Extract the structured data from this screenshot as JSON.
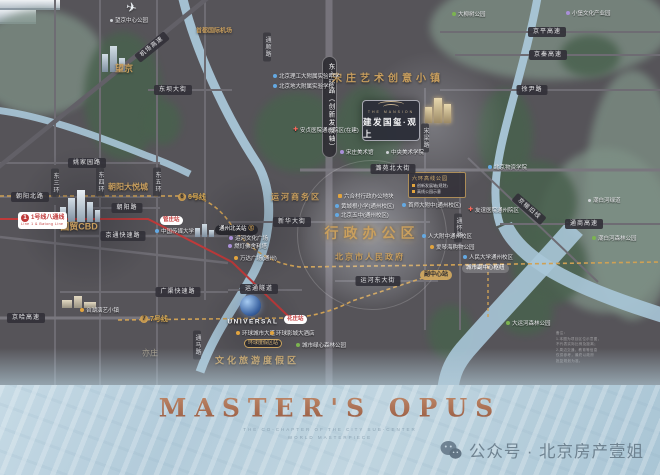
{
  "footer": {
    "title": "MASTER'S OPUS",
    "subtitle1": "THE CO-CHAPTER OF THE CITY SUB-CENTER",
    "subtitle2": "WORLD MASTERPIECE",
    "watermark": "公众号 · 北京房产壹姐"
  },
  "project_card": {
    "name_en": "THE MANSION",
    "name_cn": "建发国玺·观上"
  },
  "plan_card": {
    "title": "六环高线公园",
    "row1": "创新发展轴(规划)",
    "row2": "高线公园示意"
  },
  "ring_road_band": {
    "t": "东六环路（创新发展轴）"
  },
  "universal": {
    "t": "UNIVERSAL"
  },
  "disclaimer": {
    "lines": [
      "备注：",
      "1.本图为项目区位示意图，",
      "不代表实际比例及距离；",
      "2.周边交通、教育等信息",
      "仅供参考，最终以政府",
      "批复规划为准。"
    ]
  },
  "colors": {
    "gold": "#c99f5e",
    "metro_red": "#c03a3a",
    "river": "#a9c6d8",
    "copper": "#a8654a"
  },
  "zones": [
    {
      "t": "望京",
      "x": 124,
      "y": 68,
      "s": 9
    },
    {
      "t": "首都国际机场",
      "x": 214,
      "y": 30,
      "s": 6
    },
    {
      "t": "朝阳大悦城",
      "x": 128,
      "y": 187,
      "s": 8
    },
    {
      "t": "国贸CBD",
      "x": 79,
      "y": 226,
      "s": 9
    },
    {
      "t": "宋庄艺术创意小镇",
      "x": 388,
      "y": 77,
      "s": 10,
      "ls": 4
    },
    {
      "t": "运河商务区",
      "x": 296,
      "y": 197,
      "s": 8,
      "ls": 2
    },
    {
      "t": "行政办公区",
      "x": 372,
      "y": 233,
      "s": 14,
      "ls": 5,
      "glow": true
    },
    {
      "t": "北京市人民政府",
      "x": 370,
      "y": 257,
      "s": 8,
      "ls": 2
    },
    {
      "t": "文化旅游度假区",
      "x": 257,
      "y": 360,
      "s": 9,
      "ls": 3
    },
    {
      "t": "亦庄",
      "x": 150,
      "y": 353,
      "s": 8,
      "dim": true
    }
  ],
  "road_bands": [
    {
      "t": "机场高速",
      "x": 152,
      "y": 47,
      "r": -39
    },
    {
      "t": "东坝大街",
      "x": 173,
      "y": 90
    },
    {
      "t": "京平高速",
      "x": 547,
      "y": 32
    },
    {
      "t": "京秦高速",
      "x": 548,
      "y": 55
    },
    {
      "t": "徐尹路",
      "x": 532,
      "y": 90
    },
    {
      "t": "姚家园路",
      "x": 87,
      "y": 163
    },
    {
      "t": "潞苑北大街",
      "x": 393,
      "y": 169
    },
    {
      "t": "朝阳北路",
      "x": 30,
      "y": 197
    },
    {
      "t": "朝阳路",
      "x": 127,
      "y": 208
    },
    {
      "t": "新华大街",
      "x": 292,
      "y": 222
    },
    {
      "t": "通商高速",
      "x": 584,
      "y": 224
    },
    {
      "t": "京通快速路",
      "x": 123,
      "y": 236
    },
    {
      "t": "京榆旧线",
      "x": 529,
      "y": 209,
      "r": 41
    },
    {
      "t": "运河东大街",
      "x": 378,
      "y": 281
    },
    {
      "t": "运通隧道",
      "x": 259,
      "y": 289
    },
    {
      "t": "广渠快速路",
      "x": 178,
      "y": 292
    },
    {
      "t": "京哈高速",
      "x": 26,
      "y": 318
    }
  ],
  "vertical_roads": [
    {
      "t": "通顺路",
      "x": 267,
      "y": 47
    },
    {
      "t": "东三环",
      "x": 55,
      "y": 183
    },
    {
      "t": "东四环",
      "x": 100,
      "y": 182
    },
    {
      "t": "东五环",
      "x": 157,
      "y": 182
    },
    {
      "t": "宋梁路",
      "x": 425,
      "y": 138
    },
    {
      "t": "通怀路",
      "x": 458,
      "y": 228
    },
    {
      "t": "通马路",
      "x": 197,
      "y": 345
    }
  ],
  "pois": [
    {
      "t": "望京中心公园",
      "x": 110,
      "y": 20,
      "c": "d"
    },
    {
      "t": "大柳树公园",
      "x": 452,
      "y": 14,
      "c": "g"
    },
    {
      "t": "小堡文化产业园",
      "x": 566,
      "y": 13,
      "c": "p"
    },
    {
      "t": "北京理工大附属实验中学",
      "x": 273,
      "y": 76,
      "c": "b"
    },
    {
      "t": "北京地大附属实验学校",
      "x": 273,
      "y": 86,
      "c": "b"
    },
    {
      "t": "安贞医院通州院区(在建)",
      "x": 293,
      "y": 130,
      "c": "r"
    },
    {
      "t": "宋庄美术馆",
      "x": 340,
      "y": 152,
      "c": "p"
    },
    {
      "t": "中央美术学院",
      "x": 386,
      "y": 152,
      "c": "d"
    },
    {
      "t": "北京物资学院",
      "x": 488,
      "y": 167,
      "c": "b"
    },
    {
      "t": "潮白河绿道",
      "x": 588,
      "y": 200,
      "c": "d"
    },
    {
      "t": "友谊医院通州院区",
      "x": 468,
      "y": 210,
      "c": "r"
    },
    {
      "t": "潮白河森林公园",
      "x": 592,
      "y": 238,
      "c": "g"
    },
    {
      "t": "六合村行政办公地块",
      "x": 338,
      "y": 196,
      "c": "sq"
    },
    {
      "t": "黄城根小学(通州校区)",
      "x": 335,
      "y": 206,
      "c": "b"
    },
    {
      "t": "北京五中(通州校区)",
      "x": 335,
      "y": 215,
      "c": "b"
    },
    {
      "t": "首师大附中(通州校区)",
      "x": 402,
      "y": 205,
      "c": "b"
    },
    {
      "t": "人大附中通州校区",
      "x": 422,
      "y": 236,
      "c": "b"
    },
    {
      "t": "爱琴海购物公园",
      "x": 430,
      "y": 247,
      "c": "o"
    },
    {
      "t": "人民大学通州校区",
      "x": 463,
      "y": 257,
      "c": "b"
    },
    {
      "t": "中国传媒大学",
      "x": 155,
      "y": 231,
      "c": "b"
    },
    {
      "t": "运河文化广场",
      "x": 229,
      "y": 238,
      "c": "p"
    },
    {
      "t": "燃灯佛舍利塔",
      "x": 228,
      "y": 246,
      "c": "p"
    },
    {
      "t": "万达广场(通州)",
      "x": 234,
      "y": 258,
      "c": "o"
    },
    {
      "t": "台湖演艺小镇",
      "x": 80,
      "y": 310,
      "c": "o"
    },
    {
      "t": "环球城市大道",
      "x": 236,
      "y": 333,
      "c": "o"
    },
    {
      "t": "环球影城大酒店",
      "x": 270,
      "y": 333,
      "c": "o"
    },
    {
      "t": "城市绿心森林公园",
      "x": 296,
      "y": 345,
      "c": "g"
    },
    {
      "t": "大运河森林公园",
      "x": 506,
      "y": 323,
      "c": "g"
    }
  ],
  "stations": [
    {
      "t": "1号线八通线",
      "sub": "Line 1 & Batong Line",
      "x": 18,
      "y": 212,
      "k": "line-red",
      "n": "1"
    },
    {
      "t": "6号线",
      "x": 178,
      "y": 193,
      "k": "line-gold",
      "n": "6"
    },
    {
      "t": "7号线",
      "x": 140,
      "y": 315,
      "k": "line-gold",
      "n": "7"
    },
    {
      "t": "管庄站",
      "x": 160,
      "y": 216,
      "k": "stn-red"
    },
    {
      "t": "通州北关站",
      "x": 215,
      "y": 225,
      "k": "stn-dark"
    },
    {
      "t": "副中心站",
      "x": 420,
      "y": 270,
      "k": "stn-goldfill"
    },
    {
      "t": "城市副中心枢纽",
      "x": 462,
      "y": 264,
      "k": "stn-ghost"
    },
    {
      "t": "花庄站",
      "x": 284,
      "y": 315,
      "k": "stn-red"
    },
    {
      "t": "环球度假区站",
      "x": 244,
      "y": 339,
      "k": "stn-goldline"
    }
  ]
}
